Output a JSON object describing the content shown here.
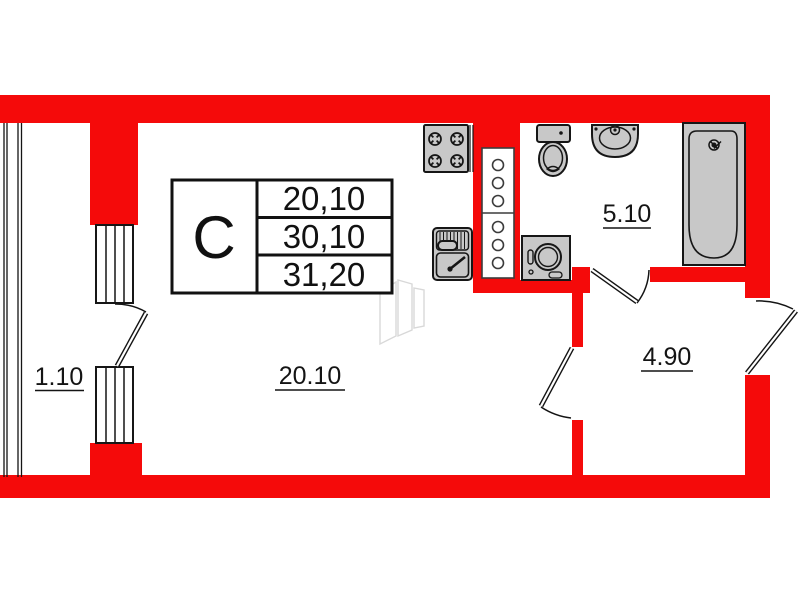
{
  "plan_title": "studio-apartment-floor-plan",
  "colors": {
    "wall_red": "#f50a0a",
    "fixture_gray": "#c8c8c8",
    "line_black": "#141414",
    "watermark_gray": "#d2d2d2"
  },
  "unit": {
    "type_label": "С",
    "areas": [
      "20,10",
      "30,10",
      "31,20"
    ]
  },
  "rooms": [
    {
      "name": "balcony",
      "area_label": "1.10"
    },
    {
      "name": "living-kitchen",
      "area_label": "20.10"
    },
    {
      "name": "bathroom",
      "area_label": "5.10"
    },
    {
      "name": "hallway",
      "area_label": "4.90"
    }
  ],
  "fixtures": [
    "stove",
    "kitchen-sink",
    "ventilation-shaft",
    "toilet",
    "wash-basin",
    "bathtub",
    "washing-machine"
  ]
}
